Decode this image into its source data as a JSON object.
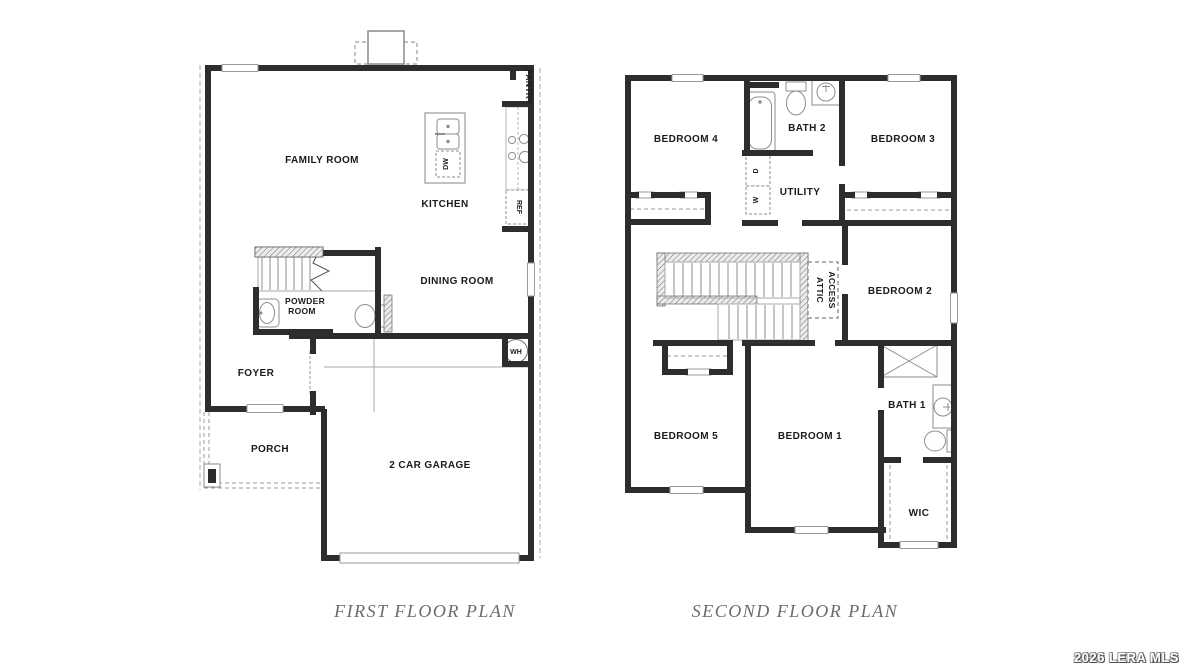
{
  "first_floor": {
    "caption": "FIRST FLOOR PLAN",
    "labels": {
      "family_room": "FAMILY ROOM",
      "kitchen": "KITCHEN",
      "pantry": "PANTRY",
      "dishwasher": "DW",
      "refrigerator": "REF",
      "dining_room": "DINING ROOM",
      "powder_room_line1": "POWDER",
      "powder_room_line2": "ROOM",
      "foyer": "FOYER",
      "porch": "PORCH",
      "garage": "2 CAR GARAGE",
      "water_heater": "WH"
    }
  },
  "second_floor": {
    "caption": "SECOND FLOOR PLAN",
    "labels": {
      "bedroom4": "BEDROOM 4",
      "bath2": "BATH 2",
      "bedroom3": "BEDROOM 3",
      "utility": "UTILITY",
      "dryer": "D",
      "washer": "W",
      "attic_access_line1": "ATTIC",
      "attic_access_line2": "ACCESS",
      "bedroom2": "BEDROOM 2",
      "bedroom5": "BEDROOM 5",
      "bedroom1": "BEDROOM 1",
      "bath1": "BATH 1",
      "wic": "WIC"
    }
  },
  "watermark": {
    "text": "2026 LERA MLS"
  },
  "colors": {
    "wall": "#2d2d2d",
    "thin_line": "#999999",
    "caption_text": "#6b6b6b",
    "watermark_fill": "#ffffff"
  }
}
